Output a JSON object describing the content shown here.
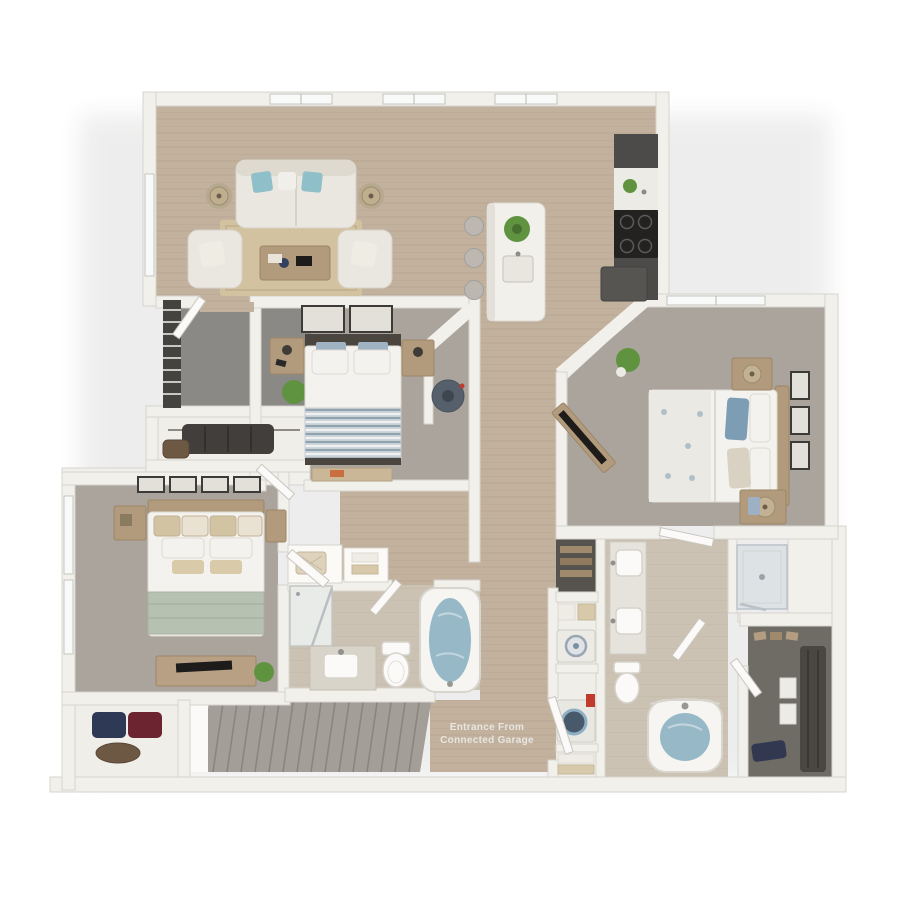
{
  "labels": {
    "entrance_line1": "Entrance From",
    "entrance_line2": "Connected Garage"
  },
  "colors": {
    "wall": "#f2f0eb",
    "wall_edge": "#d7d4ce",
    "wood": "#c2b19d",
    "wood_line": "#ad9c88",
    "carpet": "#aaa49c",
    "tile": "#cbc2b3",
    "balcony": "#8b8985",
    "closet_floor": "#6f6b65",
    "cabinet": "#4c4b49",
    "counter": "#edebe5",
    "island": "#f2f0ea",
    "rug": "#d3c2a0",
    "sofa": "#eae7e0",
    "wood_furniture": "#b29a7d",
    "white_linen": "#f4f2ee",
    "teal": "#8fc0c9",
    "blue": "#7d9db5",
    "sage": "#b7c1b1",
    "tan_pillow": "#d2c3a3",
    "water": "#96b8c7",
    "stairs": "#a39e97",
    "stair_line": "#8a857e",
    "dark_clothes": "#413e3b",
    "green": "#5f9340",
    "frame": "#3d3b38",
    "tv": "#1d1c1b",
    "steel": "#55606c",
    "red": "#c03b2e",
    "glass": "#dde3e5",
    "label_text": "#e8e6e2"
  },
  "legend": {
    "scene": "3d-apartment-floor-plan",
    "rooms": [
      "living-room",
      "kitchen",
      "balcony",
      "bedroom-2",
      "master-bedroom",
      "bedroom-3",
      "bathroom-2",
      "master-bathroom",
      "walk-in-closet",
      "laundry-closet",
      "entry-hall",
      "stairs",
      "under-stair-closet"
    ]
  }
}
